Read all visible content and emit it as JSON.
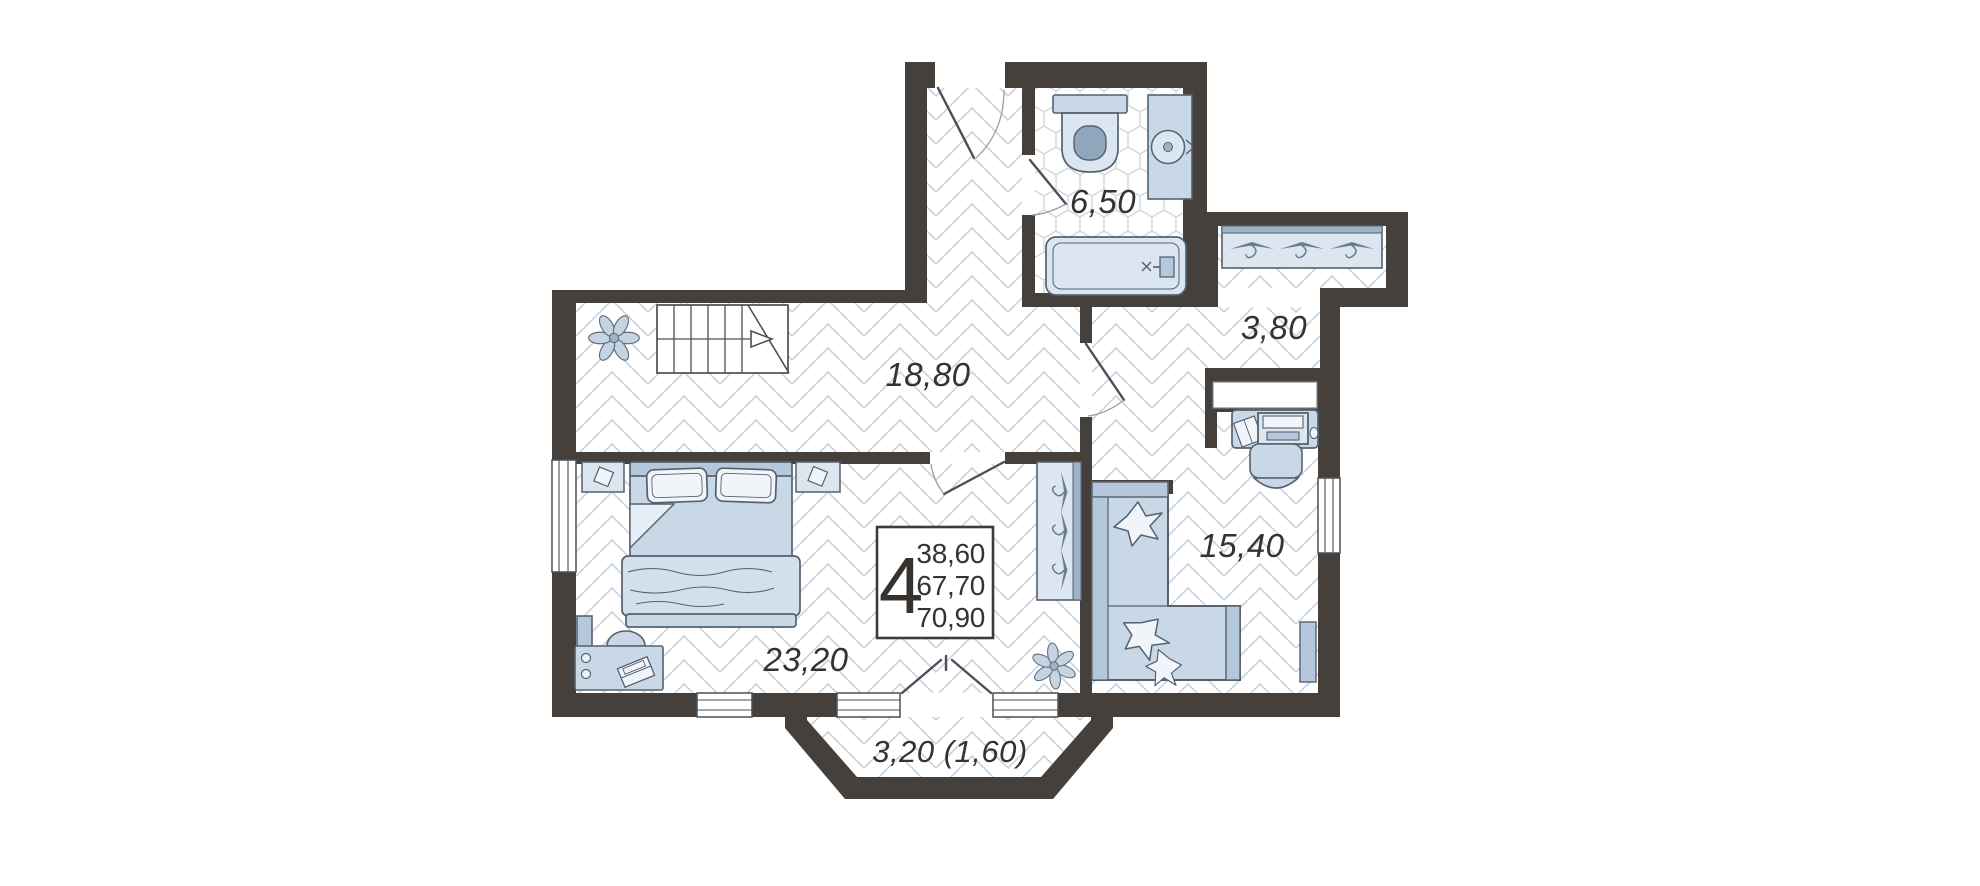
{
  "plan": {
    "summary": {
      "rooms_count": "4",
      "areas": [
        "38,60",
        "67,70",
        "70,90"
      ]
    },
    "rooms": {
      "hall": "18,80",
      "bathroom": "6,50",
      "dressing": "3,80",
      "bedroom": "23,20",
      "living": "15,40",
      "balcony": "3,20 (1,60)"
    },
    "colors": {
      "wall": "#46403d",
      "furniture_fill": "#c9d8e6",
      "furniture_outline": "#54626f",
      "floor_lines": "#ccd2d9",
      "text": "#38322e"
    }
  }
}
